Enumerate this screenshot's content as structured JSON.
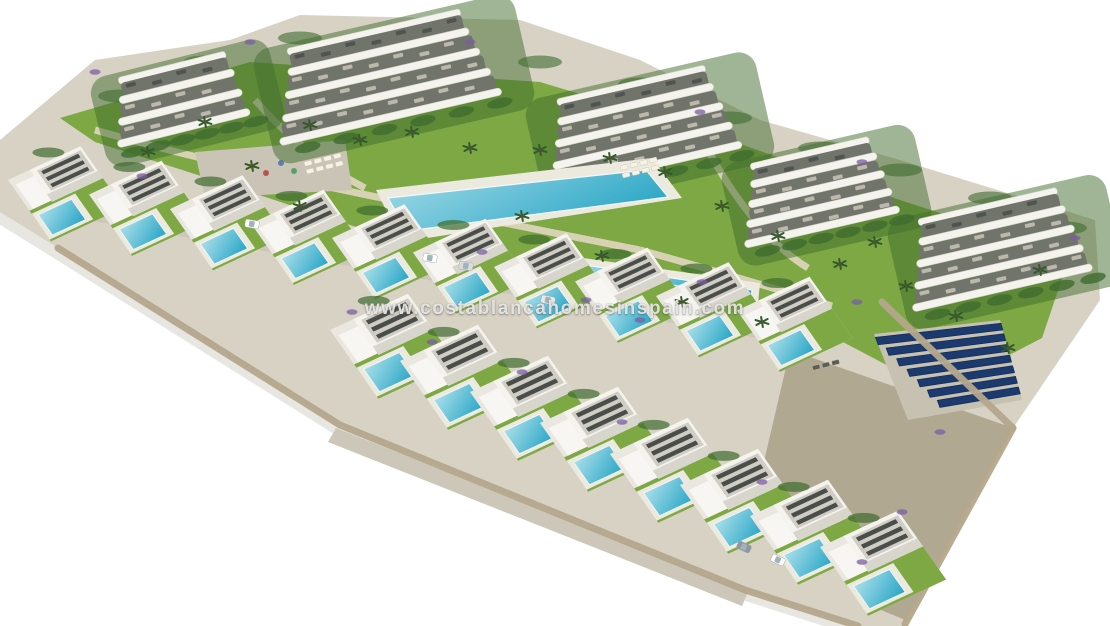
{
  "meta": {
    "type": "architectural-aerial-render",
    "subject": "New-build residential complex: curved white apartment blocks, two rows of villas with private pools, communal pools, gardens, stone terraces and solar panels, isolated on white background",
    "background": "#ffffff"
  },
  "watermark": {
    "text": "www.costablancahomesinspain.com"
  },
  "palette": {
    "terrain": "#d8d2c5",
    "shadow": "#e2e0da",
    "lawn": "#7da843",
    "hedge": "#3f6b2e",
    "tree": "#2f5c2b",
    "flower_purple": "#7b5ea3",
    "path": "#ddd4bc",
    "plaza": "#c9c4b6",
    "road": "#ccc7b9",
    "wall": "#b4a78c",
    "house_white": "#f4f3ee",
    "roof_gray": "#d0cdc4",
    "pergola_dark": "#4a4e4a",
    "window_strip": "#70746b",
    "pool_light": "#a6dce8",
    "pool_deep": "#2fa8c8",
    "deck": "#eceadf",
    "solar_blue": "#1c3a6e",
    "slope_rock": "#a79d85"
  },
  "scene": {
    "terrain": {
      "points": "0,140 95,60 230,40 300,15 520,20 640,60 760,120 900,160 1095,220 1100,300 1015,425 905,626 858,626 745,590 340,425 58,248 0,212"
    },
    "lawns": [
      {
        "points": "60,118 250,62 540,82 700,130 900,200 1070,255 1042,338 938,392 820,330 640,282 432,252 232,186 95,142"
      }
    ],
    "plazas": [
      {
        "points": "195,152 345,140 352,190 205,198"
      }
    ],
    "paths": [
      {
        "d": "M95,130 C240,172 420,206 640,250"
      },
      {
        "d": "M640,250 C720,272 780,290 832,306"
      },
      {
        "d": "M255,100 C290,140 330,170 365,188"
      },
      {
        "d": "M705,145 C735,200 770,245 808,268"
      }
    ],
    "playground_dots": [
      [
        252,
        166,
        "#d9a93c"
      ],
      [
        266,
        173,
        "#b8544e"
      ],
      [
        281,
        163,
        "#5a7fb5"
      ],
      [
        294,
        171,
        "#58a06a"
      ]
    ],
    "top_hedges": [
      [
        120,
        96
      ],
      [
        205,
        62
      ],
      [
        300,
        38
      ],
      [
        420,
        38
      ],
      [
        540,
        62
      ],
      [
        640,
        84
      ],
      [
        730,
        118
      ],
      [
        820,
        148
      ],
      [
        900,
        170
      ],
      [
        990,
        198
      ],
      [
        1065,
        228
      ]
    ],
    "apartment_buildings": [
      {
        "x": 105,
        "y": 86,
        "w": 148,
        "floors": 3,
        "fh": 21,
        "angle": -14
      },
      {
        "x": 268,
        "y": 58,
        "w": 232,
        "floors": 4,
        "fh": 22,
        "angle": -13
      },
      {
        "x": 540,
        "y": 108,
        "w": 200,
        "floors": 4,
        "fh": 21,
        "angle": -13
      },
      {
        "x": 736,
        "y": 172,
        "w": 162,
        "floors": 4,
        "fh": 19,
        "angle": -13
      },
      {
        "x": 902,
        "y": 228,
        "w": 188,
        "floors": 4,
        "fh": 21,
        "angle": -13
      }
    ],
    "main_pool": {
      "deck": "376,190 652,158 682,198 402,242",
      "water": "388,198 646,170 668,197 407,231"
    },
    "lap_pool": {
      "deck": "548,253 760,283 756,326 542,293",
      "water": "558,261 752,290 748,318 552,287",
      "lanes": 3
    },
    "loungers": [
      {
        "x": 304,
        "y": 162,
        "rows": 2,
        "cols": 4,
        "angle": -14,
        "color": "#f6f2e6"
      },
      {
        "x": 620,
        "y": 166,
        "rows": 2,
        "cols": 4,
        "angle": -14,
        "color": "#f6f2e6"
      },
      {
        "x": 812,
        "y": 366,
        "rows": 1,
        "cols": 3,
        "angle": -14,
        "color": "#5b5f58"
      }
    ],
    "villas_row1": {
      "count": 10,
      "start_x": 8,
      "start_y": 180,
      "step_x": 81,
      "step_y": 14.5,
      "w": 80,
      "h": 75
    },
    "villas_row2": {
      "count": 8,
      "start_x": 330,
      "start_y": 330,
      "step_x": 70,
      "step_y": 31,
      "w": 86,
      "h": 84
    },
    "roads": [
      {
        "points": "66,196 836,330 826,350 54,214"
      },
      {
        "points": "336,428 748,592 742,606 328,442"
      }
    ],
    "slopes": [
      {
        "points": "790,350 1013,428 905,620 862,602 762,470"
      }
    ],
    "solar": {
      "left_top": [
        874,
        334
      ],
      "left_bot": [
        908,
        420
      ],
      "right_top": [
        1000,
        320
      ],
      "right_bot": [
        1022,
        400
      ],
      "rows": 7
    },
    "walls": [
      {
        "d": "M58,248 L340,425 L745,590 L858,626"
      },
      {
        "d": "M1013,428 L905,624"
      },
      {
        "d": "M882,302 L1013,428"
      }
    ],
    "palms": [
      [
        310,
        125
      ],
      [
        360,
        140
      ],
      [
        412,
        132
      ],
      [
        470,
        148
      ],
      [
        540,
        150
      ],
      [
        610,
        158
      ],
      [
        665,
        172
      ],
      [
        722,
        206
      ],
      [
        778,
        236
      ],
      [
        840,
        264
      ],
      [
        252,
        166
      ],
      [
        300,
        206
      ],
      [
        522,
        216
      ],
      [
        602,
        256
      ],
      [
        682,
        302
      ],
      [
        762,
        322
      ],
      [
        906,
        286
      ],
      [
        956,
        316
      ],
      [
        1008,
        348
      ],
      [
        148,
        152
      ],
      [
        205,
        122
      ],
      [
        875,
        242
      ],
      [
        1040,
        270
      ]
    ],
    "flowers": [
      [
        95,
        72
      ],
      [
        250,
        42
      ],
      [
        470,
        42
      ],
      [
        700,
        112
      ],
      [
        862,
        162
      ],
      [
        1075,
        238
      ],
      [
        142,
        176
      ],
      [
        482,
        252
      ],
      [
        702,
        282
      ],
      [
        857,
        302
      ],
      [
        940,
        432
      ],
      [
        762,
        482
      ],
      [
        622,
        422
      ],
      [
        522,
        372
      ],
      [
        432,
        342
      ],
      [
        352,
        312
      ],
      [
        902,
        512
      ],
      [
        862,
        562
      ],
      [
        586,
        300
      ],
      [
        640,
        320
      ]
    ],
    "cars": [
      {
        "x": 430,
        "y": 258,
        "a": 10,
        "c": "#ffffff"
      },
      {
        "x": 466,
        "y": 266,
        "a": 10,
        "c": "#dcdcdc"
      },
      {
        "x": 252,
        "y": 224,
        "a": 10,
        "c": "#ffffff"
      },
      {
        "x": 744,
        "y": 547,
        "a": 25,
        "c": "#8f969c"
      },
      {
        "x": 778,
        "y": 560,
        "a": 25,
        "c": "#ffffff"
      },
      {
        "x": 548,
        "y": 300,
        "a": 12,
        "c": "#e8e8e8"
      }
    ]
  }
}
